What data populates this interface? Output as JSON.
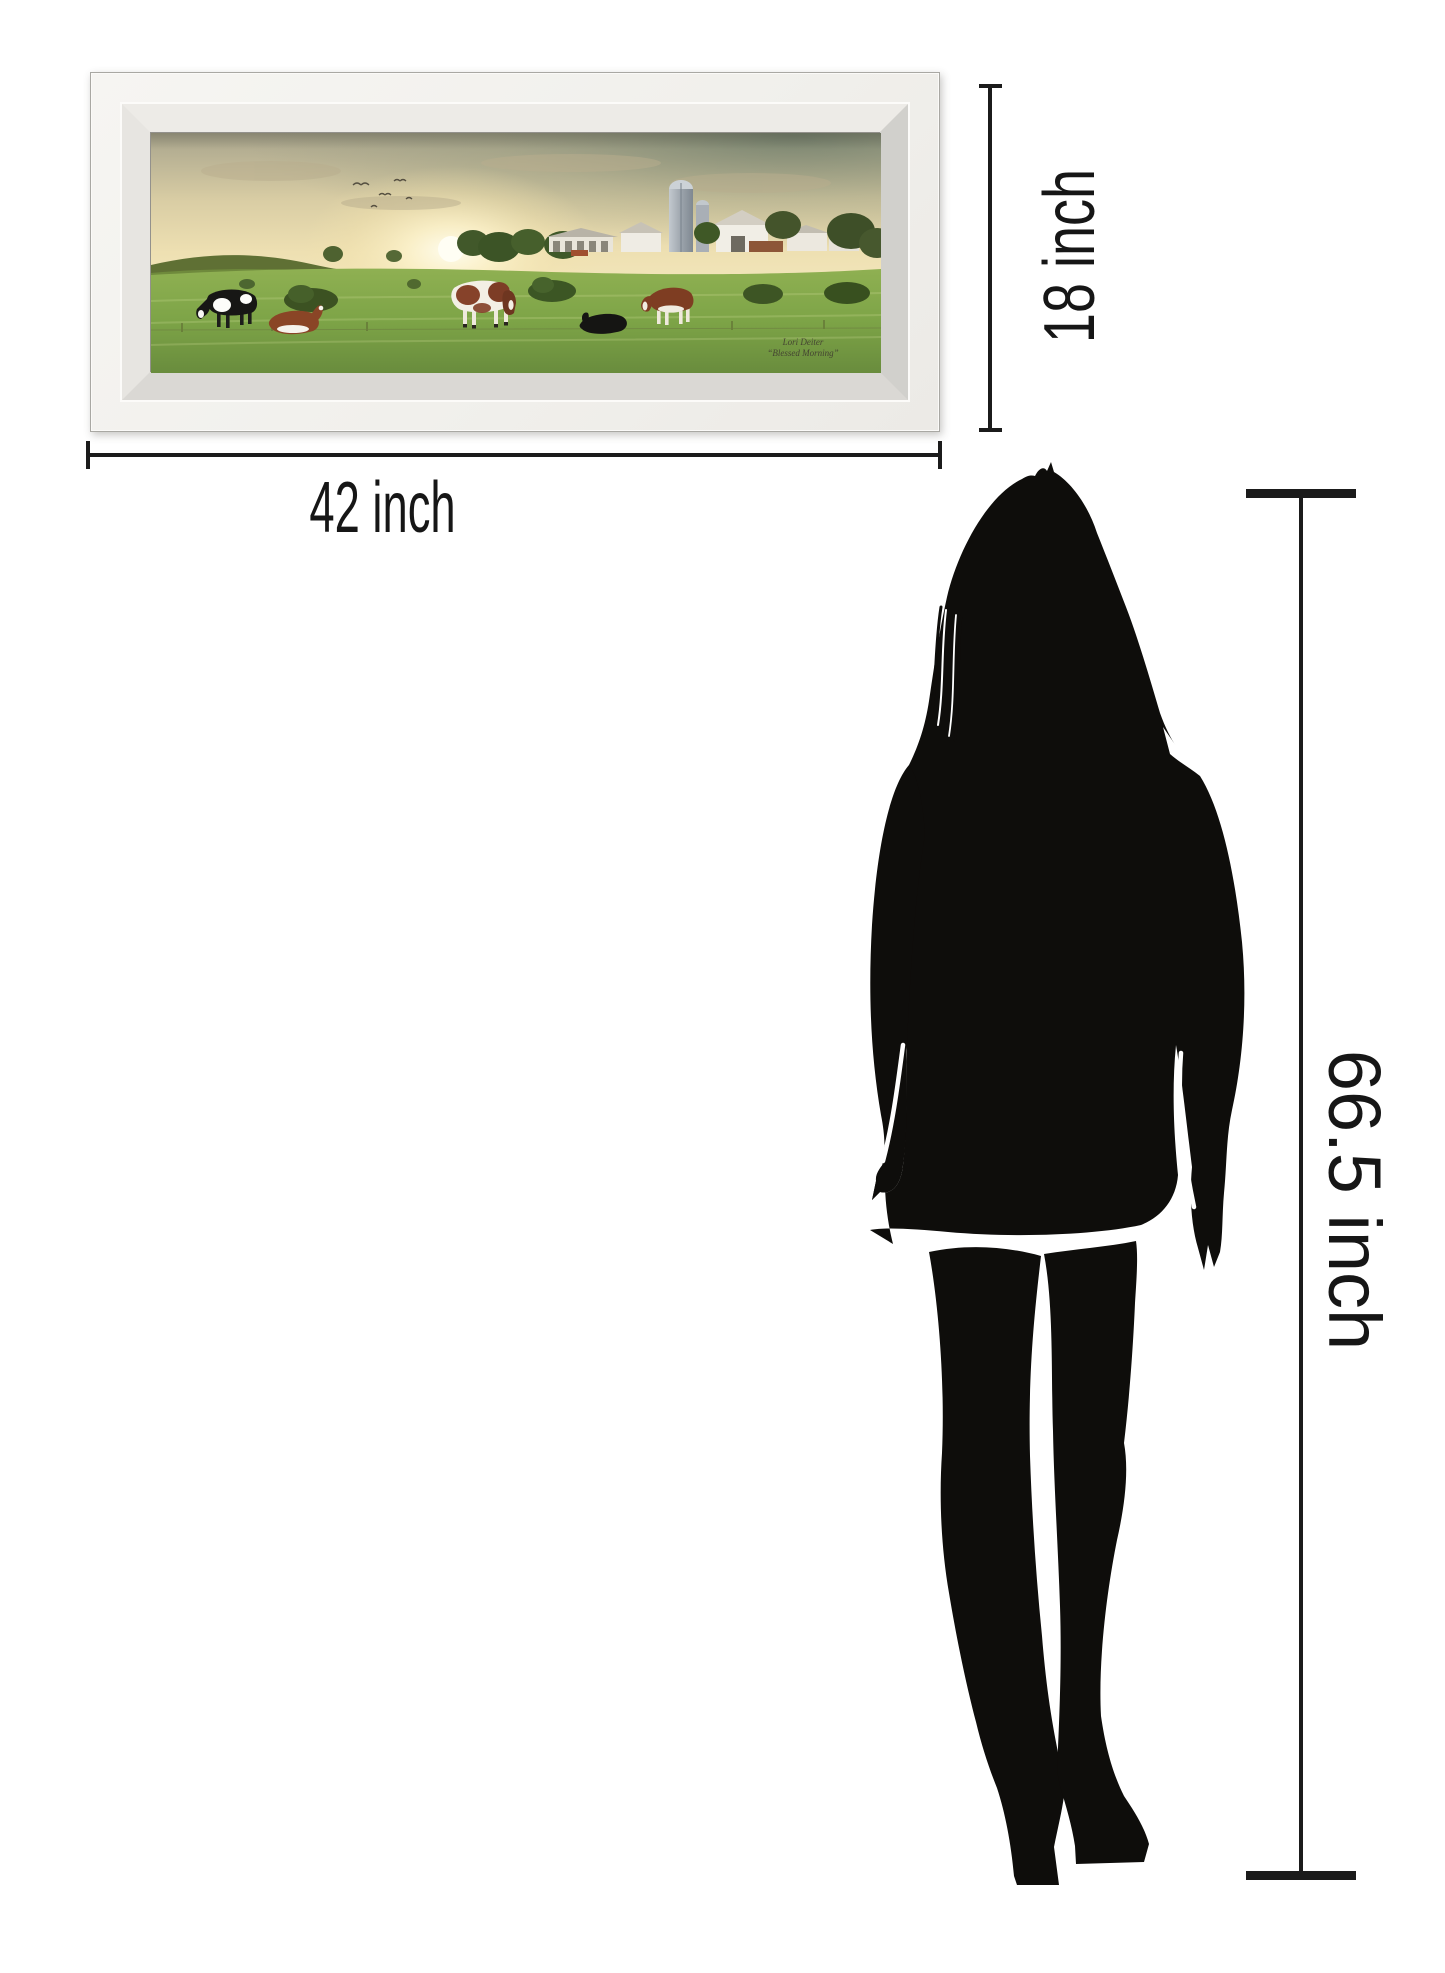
{
  "artwork": {
    "signature_artist": "Lori Deiter",
    "signature_title": "“Blessed Morning”",
    "subject": "farm pasture with cows at sunrise, barn and silo",
    "frame_style": "beveled mirror frame"
  },
  "dimensions": {
    "width_label": "42 inch",
    "height_label": "18 inch",
    "person_height_label": "66.5 inch"
  },
  "colors": {
    "background": "#ffffff",
    "dimension_lines": "#1b1b1b",
    "silhouette": "#0e0d0b",
    "frame_face": "#f3f2ef"
  }
}
